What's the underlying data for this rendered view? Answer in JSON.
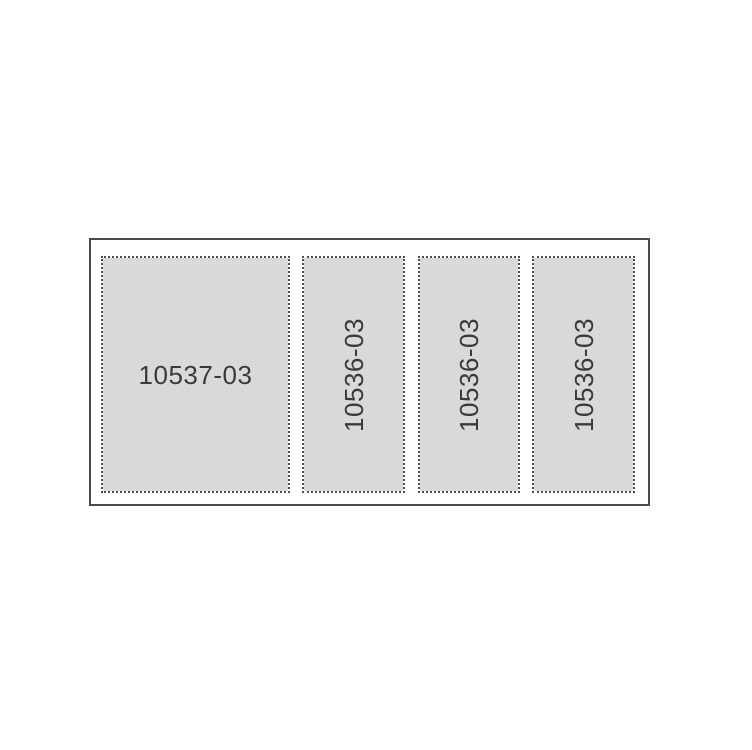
{
  "figure": {
    "description": "Label sheet layout diagram with four dotted cut-line panels inside a solid outer frame",
    "panels": [
      {
        "label": "10537-03",
        "orientation": "horizontal"
      },
      {
        "label": "10536-03",
        "orientation": "vertical"
      },
      {
        "label": "10536-03",
        "orientation": "vertical"
      },
      {
        "label": "10536-03",
        "orientation": "vertical"
      }
    ],
    "colors": {
      "background": "#ffffff",
      "outer_border": "#4b4b4b",
      "dotted_border": "#4d4d4d",
      "panel_fill": "#d9d9d9",
      "label_text": "#3a3a3a"
    }
  }
}
